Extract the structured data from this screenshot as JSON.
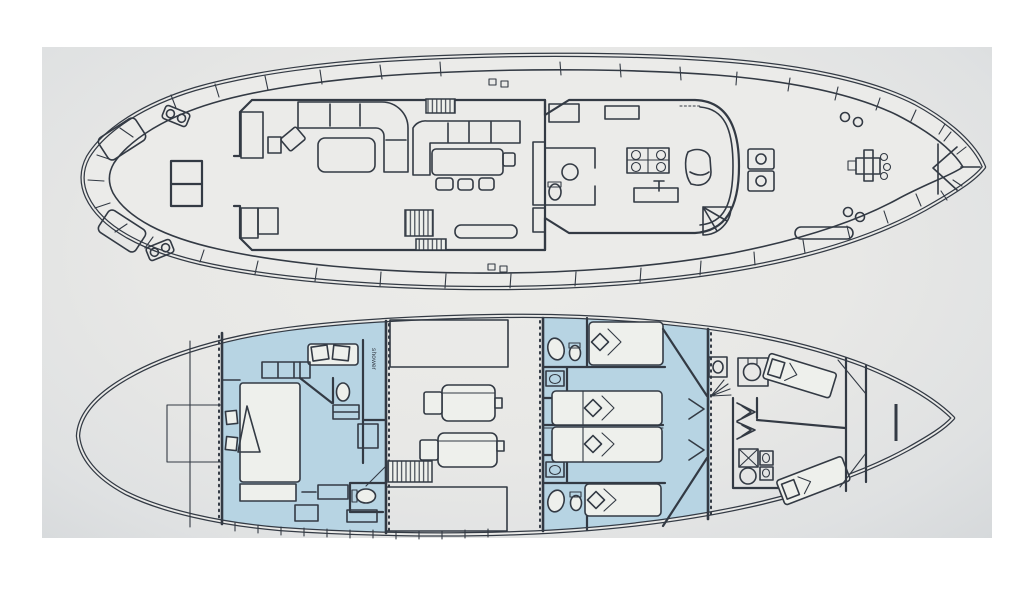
{
  "figure": {
    "kind": "yacht general arrangement plan, two decks, bow to the right",
    "source_look": "photograph of a printed line drawing on grey paper"
  },
  "colors": {
    "paper": "#e9e9e7",
    "paper_edge": "#d7dadc",
    "page_white": "#ffffff",
    "line": "#333a44",
    "cabin": "#b7d4e3",
    "object": "#eef0ec"
  },
  "diagram": {
    "upper_deck": {
      "features": [
        "aft-deck-table",
        "aft-bench-port",
        "aft-bench-starboard",
        "mooring-cleats",
        "salon-l-sofa",
        "coffee-table",
        "armchair",
        "side-table",
        "companionway-stairs-up",
        "companionway-stairs-down",
        "dining-bench",
        "dining-table",
        "stools",
        "galley-cabinets",
        "galley-counter",
        "pilothouse",
        "chart-table-with-chairs",
        "helm-seat",
        "steering-wheel",
        "helm-console",
        "day-toilet",
        "spiral-staircase",
        "deck-boxes",
        "walkway-locker",
        "anchor-windlass",
        "deck-vents",
        "bow-platform"
      ]
    },
    "lower_deck": {
      "labels": {
        "shower": "shower"
      },
      "rooms": [
        "lazarette",
        "steering-gear",
        "master-cabin",
        "master-bed",
        "master-sofa",
        "master-toilet-forward",
        "shower-room",
        "master-toilet-aft",
        "engine-room",
        "port-engine",
        "starboard-engine",
        "engine-room-stairs",
        "tank",
        "guest-bathrooms",
        "guest-cabin-beds",
        "cabin-doors",
        "crew-quarters",
        "crew-berths",
        "crew-washbasins",
        "crew-toilet",
        "forepeak",
        "chain-locker"
      ]
    }
  }
}
